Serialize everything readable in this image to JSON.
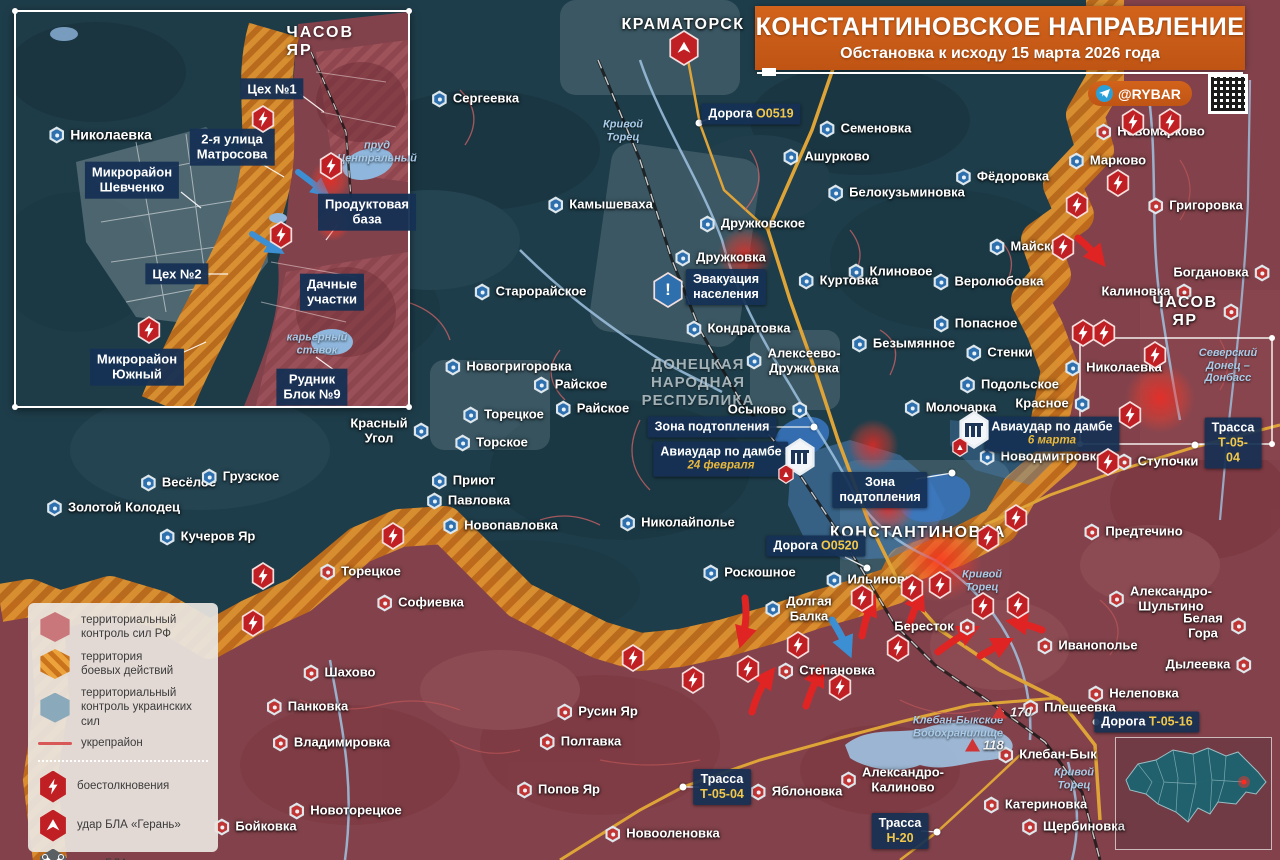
{
  "title": {
    "main": "КОНСТАНТИНОВСКОЕ НАПРАВЛЕНИЕ",
    "sub": "Обстановка к исходу 15 марта 2026 года",
    "credit": "@RYBAR"
  },
  "legend": {
    "zones": [
      {
        "k": "rf",
        "t": "территориальный|контроль сил РФ"
      },
      {
        "k": "battle",
        "t": "территория|боевых действий"
      },
      {
        "k": "ua",
        "t": "территориальный|контроль украинских сил"
      },
      {
        "k": "fort",
        "t": "укрепрайон"
      }
    ],
    "events": [
      {
        "k": "clash",
        "t": "боестолкновения"
      },
      {
        "k": "geran",
        "t": "удар БЛА «Герань»"
      },
      {
        "k": "uav",
        "t": "удар БЛА"
      }
    ]
  },
  "map": {
    "region": "ДОНЕЦКАЯ|НАРОДНАЯ|РЕСПУБЛИКА",
    "region_x": 698,
    "region_y": 383,
    "cities": [
      {
        "n": "КРАМАТОРСК",
        "x": 683,
        "y": 25
      },
      {
        "n": "КОНСТАНТИНОВКА",
        "x": 918,
        "y": 533
      },
      {
        "n": "ЧАСОВ ЯР",
        "x": 1196,
        "y": 312,
        "m": "ru",
        "ms": "r"
      }
    ],
    "places": [
      {
        "n": "Сергеевка",
        "x": 475,
        "y": 99,
        "m": "ua"
      },
      {
        "n": "Камышеваха",
        "x": 600,
        "y": 205,
        "m": "ua"
      },
      {
        "n": "Старорайское",
        "x": 530,
        "y": 292,
        "m": "ua"
      },
      {
        "n": "Дружковка",
        "x": 720,
        "y": 258,
        "m": "ua"
      },
      {
        "n": "Дружковское",
        "x": 752,
        "y": 224,
        "m": "ua"
      },
      {
        "n": "Семеновка",
        "x": 865,
        "y": 129,
        "m": "ua"
      },
      {
        "n": "Ашурково",
        "x": 826,
        "y": 157,
        "m": "ua"
      },
      {
        "n": "Белокузьминовка",
        "x": 896,
        "y": 193,
        "m": "ua"
      },
      {
        "n": "Фёдоровка",
        "x": 1002,
        "y": 177,
        "m": "ua"
      },
      {
        "n": "Марково",
        "x": 1107,
        "y": 161,
        "m": "ua"
      },
      {
        "n": "Новомарково",
        "x": 1150,
        "y": 132,
        "m": "ru"
      },
      {
        "n": "Майское",
        "x": 1027,
        "y": 247,
        "m": "ua"
      },
      {
        "n": "Клиновое",
        "x": 890,
        "y": 272,
        "m": "ua"
      },
      {
        "n": "Веролюбовка",
        "x": 988,
        "y": 282,
        "m": "ua"
      },
      {
        "n": "Куртовка",
        "x": 838,
        "y": 281,
        "m": "ua"
      },
      {
        "n": "Попасное",
        "x": 975,
        "y": 324,
        "m": "ua"
      },
      {
        "n": "Безымянное",
        "x": 903,
        "y": 344,
        "m": "ua"
      },
      {
        "n": "Стенки",
        "x": 999,
        "y": 353,
        "m": "ua"
      },
      {
        "n": "Николаевка",
        "x": 1113,
        "y": 368,
        "m": "ua"
      },
      {
        "n": "Подольское",
        "x": 1009,
        "y": 385,
        "m": "ua"
      },
      {
        "n": "Красное",
        "x": 1053,
        "y": 404,
        "m": "ua",
        "ms": "r"
      },
      {
        "n": "Молочарка",
        "x": 950,
        "y": 408,
        "m": "ua"
      },
      {
        "n": "Новодмитровка",
        "x": 1041,
        "y": 457,
        "m": "ua"
      },
      {
        "n": "Кондратовка",
        "x": 738,
        "y": 329,
        "m": "ua"
      },
      {
        "n": "Алексеево-|Дружковка",
        "x": 793,
        "y": 361,
        "m": "ua"
      },
      {
        "n": "Осыково",
        "x": 768,
        "y": 410,
        "m": "ua",
        "ms": "r"
      },
      {
        "n": "Николайполье",
        "x": 677,
        "y": 523,
        "m": "ua"
      },
      {
        "n": "Новогригоровка",
        "x": 508,
        "y": 367,
        "m": "ua"
      },
      {
        "n": "Райское",
        "x": 570,
        "y": 385,
        "m": "ua"
      },
      {
        "n": "Райское",
        "x": 592,
        "y": 409,
        "m": "ua"
      },
      {
        "n": "Торецкое",
        "x": 503,
        "y": 415,
        "m": "ua"
      },
      {
        "n": "Торское",
        "x": 491,
        "y": 443,
        "m": "ua"
      },
      {
        "n": "Красный|Угол",
        "x": 390,
        "y": 431,
        "m": "ua",
        "ms": "r"
      },
      {
        "n": "Приют",
        "x": 463,
        "y": 481,
        "m": "ua"
      },
      {
        "n": "Павловка",
        "x": 468,
        "y": 501,
        "m": "ua"
      },
      {
        "n": "Новопавловка",
        "x": 500,
        "y": 526,
        "m": "ua"
      },
      {
        "n": "Весёлое",
        "x": 178,
        "y": 483,
        "m": "ua"
      },
      {
        "n": "Грузское",
        "x": 240,
        "y": 477,
        "m": "ua"
      },
      {
        "n": "Золотой Колодец",
        "x": 113,
        "y": 508,
        "m": "ua"
      },
      {
        "n": "Кучеров Яр",
        "x": 207,
        "y": 537,
        "m": "ua"
      },
      {
        "n": "Роскошное",
        "x": 749,
        "y": 573,
        "m": "ua"
      },
      {
        "n": "Долгая|Балка",
        "x": 798,
        "y": 609,
        "m": "ua"
      },
      {
        "n": "Ильиновка",
        "x": 872,
        "y": 580,
        "m": "ua"
      },
      {
        "n": "Григоровка",
        "x": 1195,
        "y": 206,
        "m": "ru"
      },
      {
        "n": "Богдановка",
        "x": 1222,
        "y": 273,
        "m": "ru",
        "ms": "r"
      },
      {
        "n": "Калиновка",
        "x": 1147,
        "y": 292,
        "m": "ru",
        "ms": "r"
      },
      {
        "n": "Ступочки",
        "x": 1157,
        "y": 462,
        "m": "ru"
      },
      {
        "n": "Предтечино",
        "x": 1133,
        "y": 532,
        "m": "ru"
      },
      {
        "n": "Бересток",
        "x": 935,
        "y": 627,
        "m": "ru",
        "ms": "r"
      },
      {
        "n": "Степановка",
        "x": 826,
        "y": 671,
        "m": "ru"
      },
      {
        "n": "Торецкое",
        "x": 360,
        "y": 572,
        "m": "ru"
      },
      {
        "n": "Софиевка",
        "x": 420,
        "y": 603,
        "m": "ru"
      },
      {
        "n": "Шахово",
        "x": 339,
        "y": 673,
        "m": "ru"
      },
      {
        "n": "Панковка",
        "x": 307,
        "y": 707,
        "m": "ru"
      },
      {
        "n": "Владимировка",
        "x": 331,
        "y": 743,
        "m": "ru"
      },
      {
        "n": "Русин Яр",
        "x": 597,
        "y": 712,
        "m": "ru"
      },
      {
        "n": "Полтавка",
        "x": 580,
        "y": 742,
        "m": "ru"
      },
      {
        "n": "Попов Яр",
        "x": 558,
        "y": 790,
        "m": "ru"
      },
      {
        "n": "Новоторецкое",
        "x": 345,
        "y": 811,
        "m": "ru"
      },
      {
        "n": "Бойковка",
        "x": 255,
        "y": 827,
        "m": "ru"
      },
      {
        "n": "Новооленовка",
        "x": 662,
        "y": 834,
        "m": "ru"
      },
      {
        "n": "Яблоновка",
        "x": 796,
        "y": 792,
        "m": "ru"
      },
      {
        "n": "Александро-|Калиново",
        "x": 892,
        "y": 780,
        "m": "ru"
      },
      {
        "n": "Клебан-Бык",
        "x": 1047,
        "y": 755,
        "m": "ru"
      },
      {
        "n": "Катериновка",
        "x": 1035,
        "y": 805,
        "m": "ru"
      },
      {
        "n": "Щербиновка",
        "x": 1073,
        "y": 827,
        "m": "ru"
      },
      {
        "n": "Плещеевка",
        "x": 1069,
        "y": 708,
        "m": "ru"
      },
      {
        "n": "Нелеповка",
        "x": 1133,
        "y": 694,
        "m": "ru"
      },
      {
        "n": "Иванополье",
        "x": 1087,
        "y": 646,
        "m": "ru"
      },
      {
        "n": "Александро-|Шультино",
        "x": 1160,
        "y": 599,
        "m": "ru"
      },
      {
        "n": "Белая Гора",
        "x": 1214,
        "y": 626,
        "m": "ru",
        "ms": "r"
      },
      {
        "n": "Дылеевка",
        "x": 1209,
        "y": 665,
        "m": "ru",
        "ms": "r"
      }
    ],
    "rivers": [
      {
        "t": "Кривой|Торец",
        "x": 623,
        "y": 131
      },
      {
        "t": "Кривой|Торец",
        "x": 982,
        "y": 581
      },
      {
        "t": "Кривой|Торец",
        "x": 1074,
        "y": 779
      },
      {
        "t": "Северский|Донец –|Донбасс",
        "x": 1228,
        "y": 366
      },
      {
        "t": "Клебан-Быкское|Водохранилище",
        "x": 958,
        "y": 727
      }
    ],
    "roads": [
      {
        "t": "Дорога",
        "n": "О0519",
        "x": 751,
        "y": 114,
        "dx": 699,
        "dy": 123
      },
      {
        "t": "Дорога",
        "n": "О0520",
        "x": 816,
        "y": 546,
        "dx": 867,
        "dy": 568
      },
      {
        "t": "Трасса",
        "n": "Т-05-04",
        "x": 1233,
        "y": 443,
        "two": 1,
        "dx": 1195,
        "dy": 445
      },
      {
        "t": "Трасса",
        "n": "Т-05-04",
        "x": 722,
        "y": 787,
        "two": 1,
        "dx": 683,
        "dy": 787
      },
      {
        "t": "Трасса",
        "n": "Н-20",
        "x": 900,
        "y": 831,
        "two": 1,
        "dx": 937,
        "dy": 832
      },
      {
        "t": "Дорога",
        "n": "Т-05-16",
        "x": 1147,
        "y": 722,
        "dx": 1096,
        "dy": 722
      }
    ],
    "events": [
      {
        "k": "evac",
        "t": "Эвакуация|населения",
        "x": 726,
        "y": 287,
        "ix": 668,
        "iy": 290
      },
      {
        "k": "dam",
        "t": "Авиаудар по дамбе",
        "sub": "24 февраля",
        "x": 721,
        "y": 459,
        "ix": 800,
        "iy": 457
      },
      {
        "k": "dam",
        "t": "Авиаудар по дамбе",
        "sub": "6 марта",
        "x": 1052,
        "y": 434,
        "ix": 974,
        "iy": 430
      },
      {
        "k": "flood",
        "t": "Зона подтопления",
        "x": 712,
        "y": 427,
        "dx": 814,
        "dy": 427
      },
      {
        "k": "flood",
        "t": "Зона|подтопления",
        "x": 880,
        "y": 490,
        "dx": 952,
        "dy": 473
      }
    ],
    "heights": [
      {
        "v": "170",
        "x": 992,
        "y": 712
      },
      {
        "v": "118",
        "x": 965,
        "y": 745
      }
    ],
    "bolts": [
      [
        1133,
        122
      ],
      [
        1170,
        122
      ],
      [
        1118,
        183
      ],
      [
        1077,
        205
      ],
      [
        1063,
        247
      ],
      [
        1083,
        333
      ],
      [
        1104,
        333
      ],
      [
        1155,
        355
      ],
      [
        1130,
        415
      ],
      [
        1108,
        462
      ],
      [
        1016,
        518
      ],
      [
        988,
        538
      ],
      [
        862,
        598
      ],
      [
        912,
        588
      ],
      [
        940,
        585
      ],
      [
        983,
        606
      ],
      [
        1018,
        605
      ],
      [
        633,
        658
      ],
      [
        693,
        680
      ],
      [
        748,
        669
      ],
      [
        798,
        645
      ],
      [
        840,
        687
      ],
      [
        898,
        648
      ],
      [
        263,
        576
      ],
      [
        253,
        623
      ],
      [
        393,
        536
      ]
    ],
    "geran": [
      [
        684,
        48
      ]
    ],
    "glows": [
      [
        745,
        255,
        56
      ],
      [
        1160,
        398,
        70
      ],
      [
        873,
        445,
        52
      ],
      [
        940,
        560,
        84
      ],
      [
        888,
        508,
        52
      ]
    ]
  },
  "inset": {
    "title": "ЧАСОВ ЯР",
    "title_x": 311,
    "title_y": 30,
    "labels": [
      {
        "k": "town",
        "t": "Николаевка",
        "x": 84,
        "y": 123,
        "m": "ua"
      },
      {
        "k": "badge",
        "t": "Цех №1",
        "x": 256,
        "y": 77
      },
      {
        "k": "badge",
        "t": "2-я улица|Матросова",
        "x": 216,
        "y": 135
      },
      {
        "k": "badge",
        "t": "Микрорайон|Шевченко",
        "x": 116,
        "y": 168
      },
      {
        "k": "badge",
        "t": "Продуктовая|база",
        "x": 351,
        "y": 200
      },
      {
        "k": "badge",
        "t": "Цех №2",
        "x": 161,
        "y": 262
      },
      {
        "k": "badge",
        "t": "Дачные|участки",
        "x": 316,
        "y": 280
      },
      {
        "k": "badge",
        "t": "Микрорайон|Южный",
        "x": 121,
        "y": 355
      },
      {
        "k": "badge",
        "t": "Рудник|Блок №9",
        "x": 296,
        "y": 375
      },
      {
        "k": "river",
        "t": "пруд|Центральный",
        "x": 361,
        "y": 140
      },
      {
        "k": "river",
        "t": "карьерный|ставок",
        "x": 301,
        "y": 332
      }
    ],
    "bolts": [
      [
        247,
        107
      ],
      [
        315,
        154
      ],
      [
        265,
        223
      ],
      [
        133,
        318
      ]
    ],
    "glows": [
      [
        314,
        168,
        40
      ],
      [
        317,
        212,
        34
      ]
    ]
  }
}
